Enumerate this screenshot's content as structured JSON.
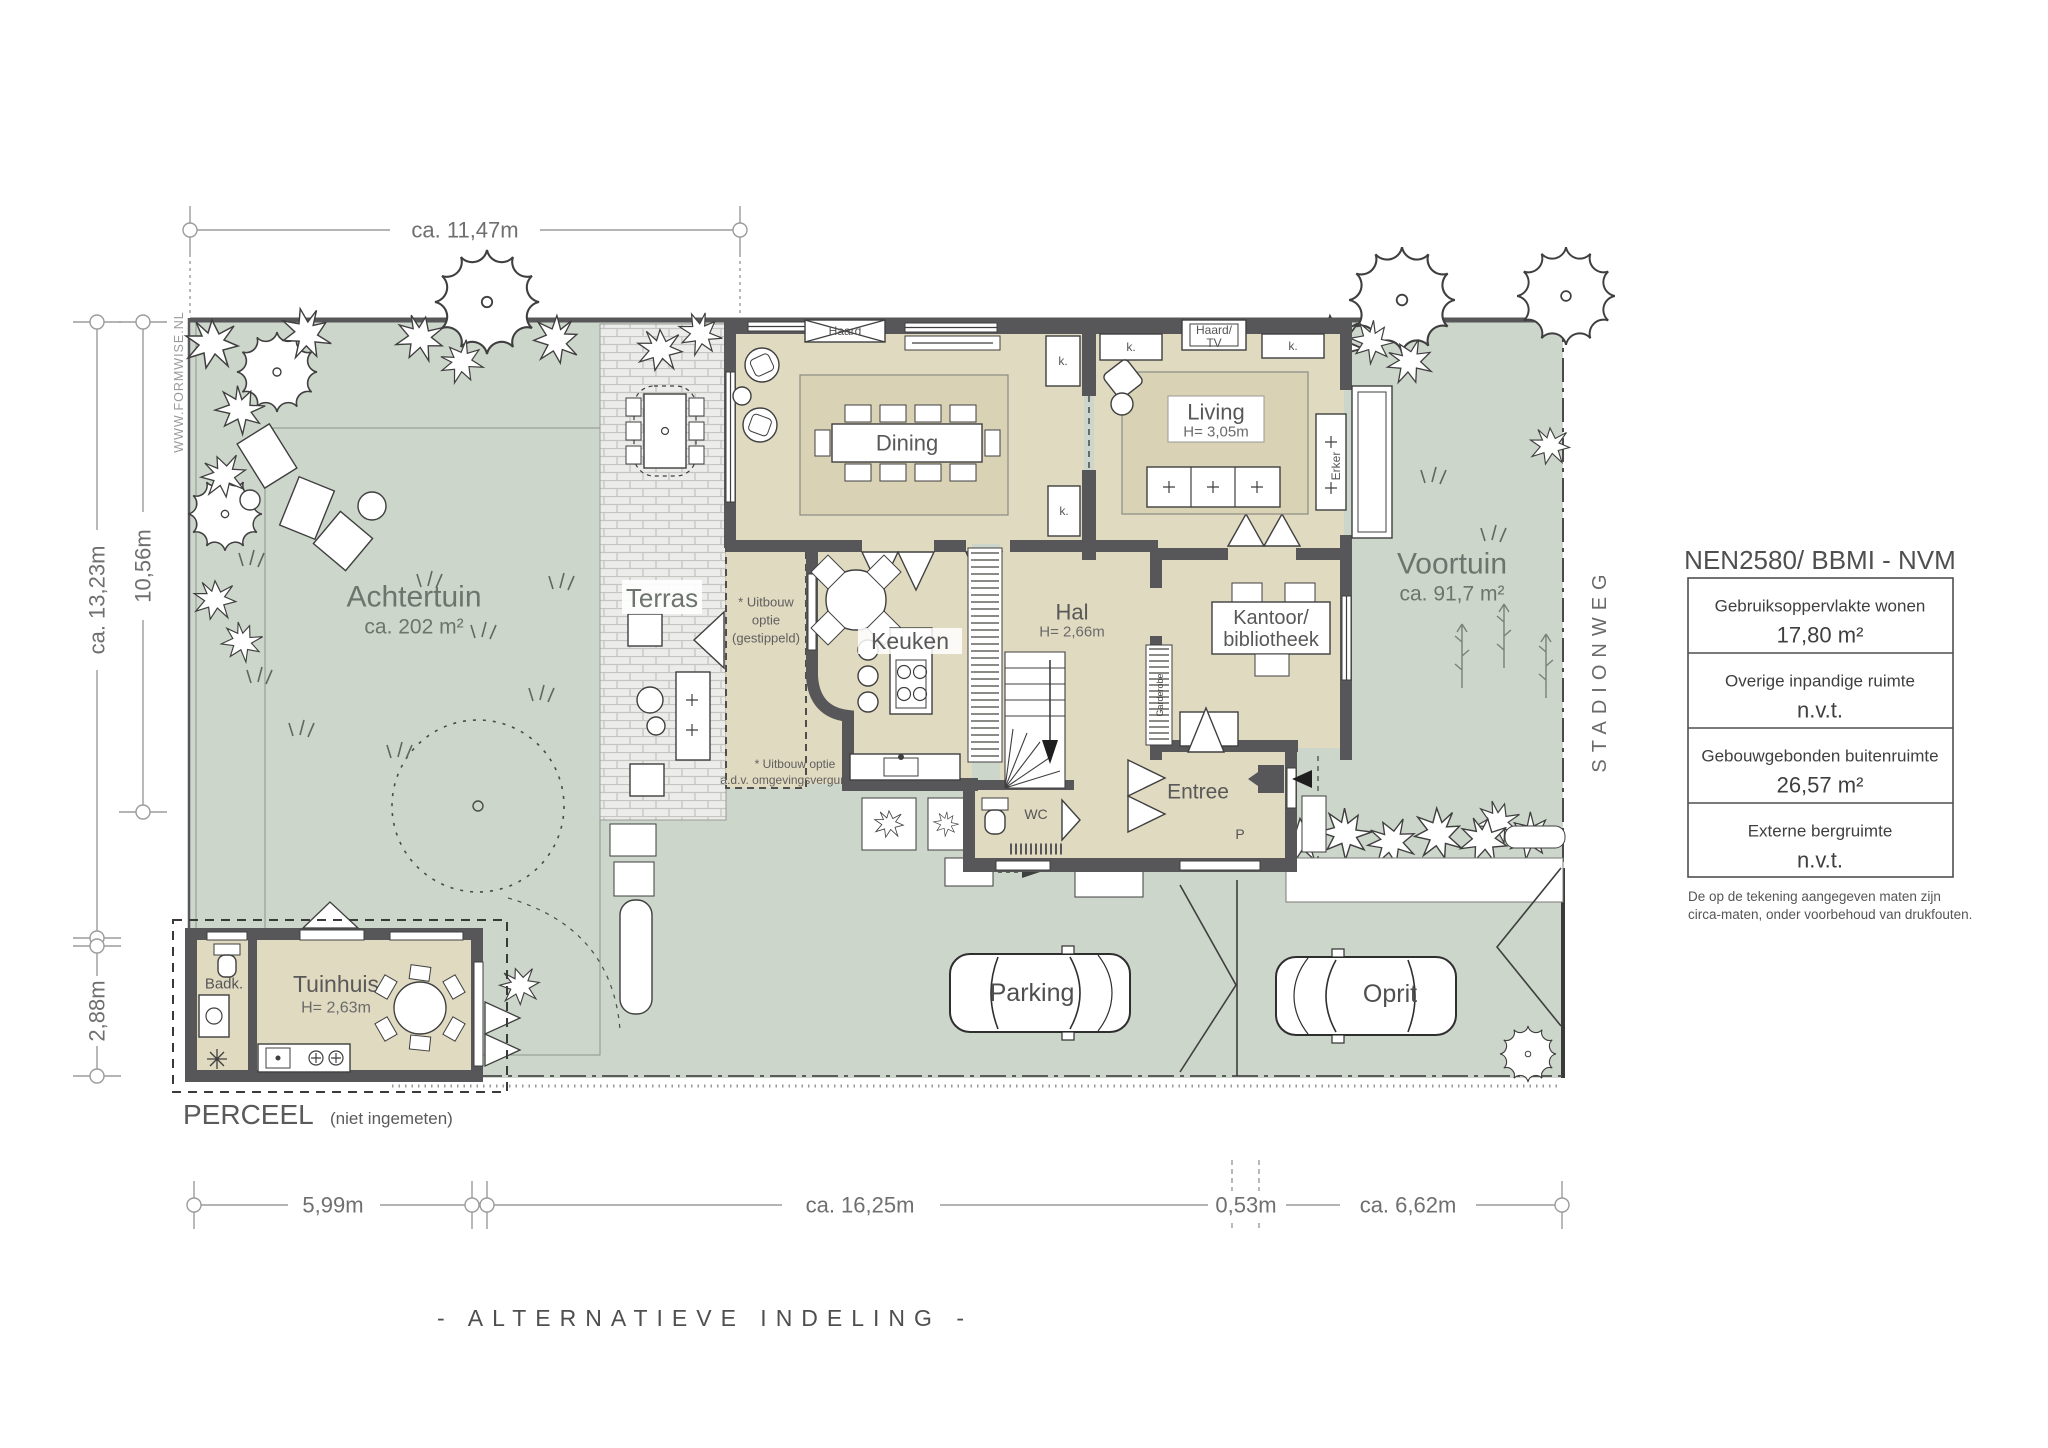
{
  "doc": {
    "title": "- ALTERNATIEVE INDELING -",
    "watermark": "WWW.FORMWISE.NL",
    "street": "STADIONWEG"
  },
  "perceel": {
    "label": "PERCEEL",
    "note": "(niet ingemeten)"
  },
  "dims": {
    "top": "ca. 11,47m",
    "left_total": "ca. 13,23m",
    "left_garden": "10,56m",
    "left_tuinhuis": "2,88m",
    "bottom_left": "5,99m",
    "bottom_house": "ca. 16,25m",
    "bottom_gap": "0,53m",
    "bottom_right": "ca. 6,62m"
  },
  "garden": {
    "back": {
      "name": "Achtertuin",
      "area": "ca. 202 m²"
    },
    "front": {
      "name": "Voortuin",
      "area": "ca. 91,7 m²"
    },
    "terrace": "Terras",
    "parking": "Parking",
    "driveway": "Oprit"
  },
  "rooms": {
    "dining": "Dining",
    "living": {
      "name": "Living",
      "height": "H= 3,05m"
    },
    "kitchen": "Keuken",
    "hall": {
      "name": "Hal",
      "height": "H= 2,66m"
    },
    "office": {
      "line1": "Kantoor/",
      "line2": "bibliotheek"
    },
    "entry": "Entree",
    "toilet": "WC",
    "garden_house": {
      "name": "Tuinhuis",
      "height": "H= 2,63m"
    },
    "bathroom": "Badk.",
    "wardrobe": "Garderobe",
    "closet": "k.",
    "fireplace": "Haard",
    "fireplace_tv_1": "Haard/",
    "fireplace_tv_2": "TV",
    "bay_window": "Erker",
    "parking_spot": "P"
  },
  "notes": {
    "ext1_1": "* Uitbouw",
    "ext1_2": "optie",
    "ext1_3": "(gestippeld)",
    "ext2_1": "* Uitbouw optie",
    "ext2_2": "a.d.v. omgevingsvergunning"
  },
  "legend": {
    "title": "NEN2580/ BBMI - NVM",
    "rows": [
      {
        "label": "Gebruiksoppervlakte wonen",
        "value": "17,80 m²"
      },
      {
        "label": "Overige inpandige ruimte",
        "value": "n.v.t."
      },
      {
        "label": "Gebouwgebonden buitenruimte",
        "value": "26,57 m²"
      },
      {
        "label": "Externe bergruimte",
        "value": "n.v.t."
      }
    ],
    "footnote1": "De op de tekening aangegeven maten zijn",
    "footnote2": "circa-maten, onder voorbehoud van drukfouten."
  },
  "colors": {
    "plot_green": "#ccd6ca",
    "room_beige": "#e0dac1",
    "wall_gray": "#57575a"
  }
}
